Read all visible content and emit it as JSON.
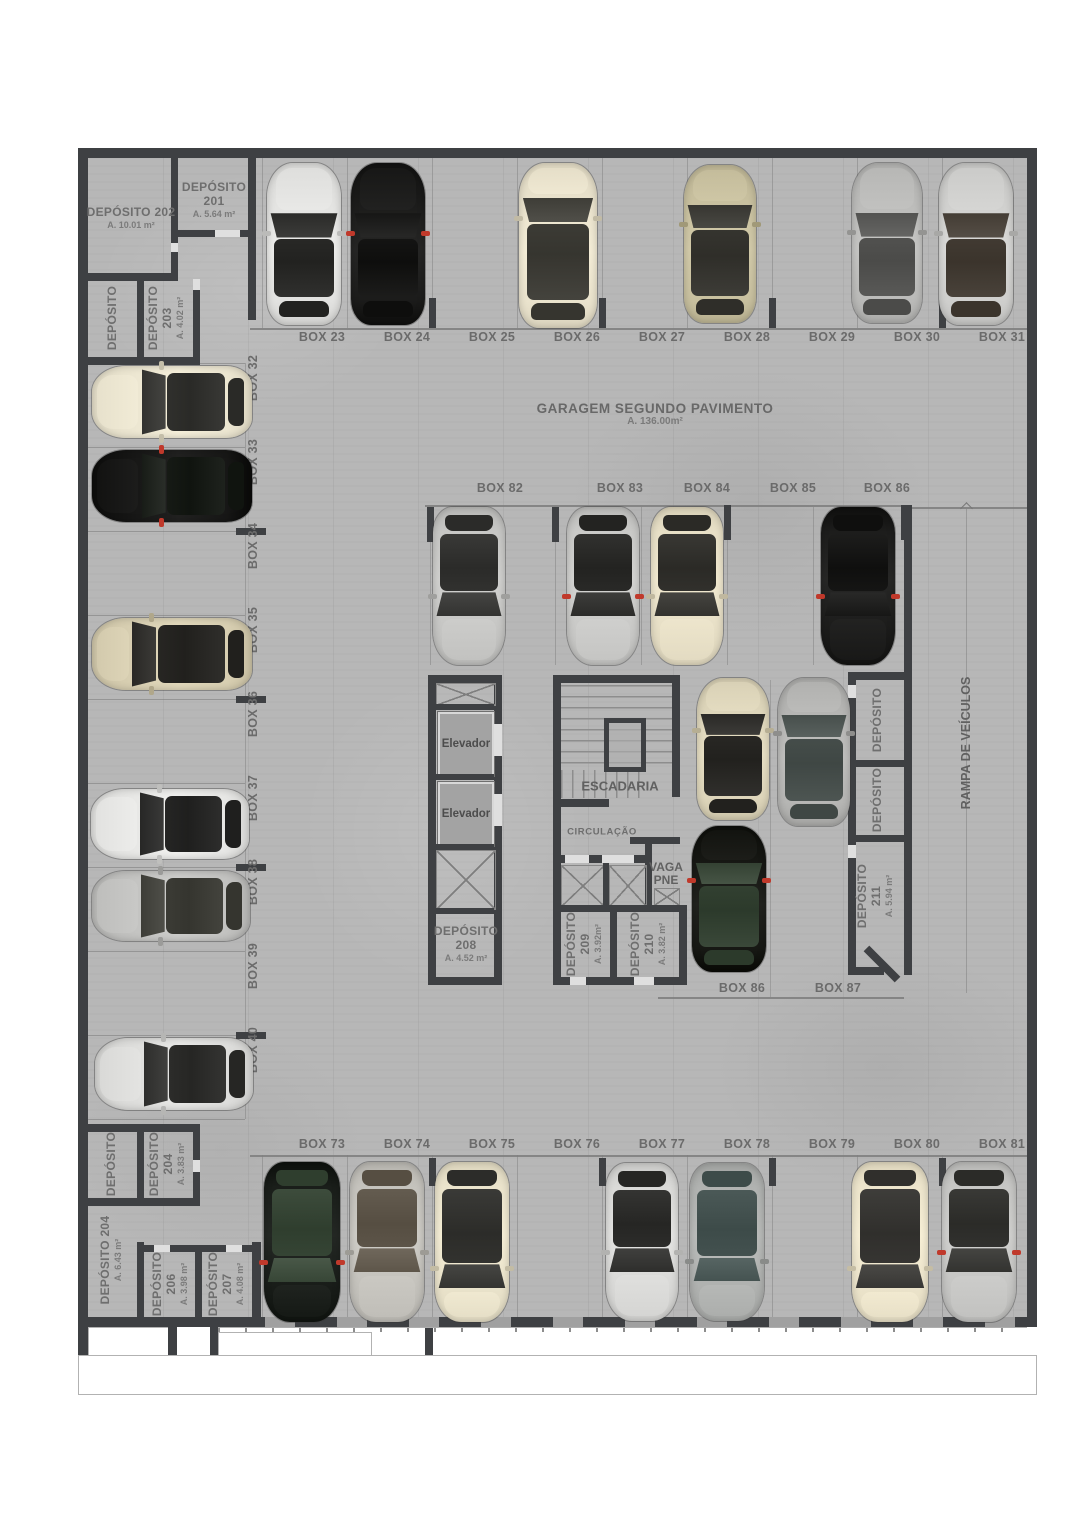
{
  "header": {
    "title": "GARAGEM SEGUNDO PAVIMENTO",
    "area": "A. 136.00m²"
  },
  "core": {
    "elevator1": "Elevador",
    "elevator2": "Elevador",
    "stairs": "ESCADARIA",
    "circulation": "CIRCULAÇÃO",
    "vaga_line1": "VAGA",
    "vaga_line2": "PNE",
    "ramp": "RAMPA DE VEÍCULOS"
  },
  "parking": {
    "top_row": [
      "BOX 23",
      "BOX 24",
      "BOX 25",
      "BOX 26",
      "BOX 27",
      "BOX 28",
      "BOX 29",
      "BOX 30",
      "BOX 31"
    ],
    "left_col": [
      "BOX 32",
      "BOX 33",
      "BOX 34",
      "BOX 35",
      "BOX 36",
      "BOX 37",
      "BOX 38",
      "BOX 39",
      "BOX 40"
    ],
    "mid_row": [
      "BOX 82",
      "BOX 83",
      "BOX 84",
      "BOX 85",
      "BOX 86"
    ],
    "mid_bottom": [
      "BOX 86",
      "BOX 87"
    ],
    "bottom_row": [
      "BOX 73",
      "BOX 74",
      "BOX 75",
      "BOX 76",
      "BOX 77",
      "BOX 78",
      "BOX 79",
      "BOX 80",
      "BOX 81"
    ]
  },
  "depots": {
    "d202": {
      "name": "DEPÓSITO 202",
      "area": "A. 10.01 m²"
    },
    "d201": {
      "name": "DEPÓSITO",
      "num": "201",
      "area": "A. 5.64 m²"
    },
    "d_tl": {
      "name": "DEPÓSITO"
    },
    "d203": {
      "name": "DEPÓSITO",
      "num": "203",
      "area": "A. 4.02 m²"
    },
    "d208": {
      "name": "DEPÓSITO",
      "num": "208",
      "area": "A. 4.52 m²"
    },
    "d209": {
      "name": "DEPÓSITO",
      "num": "209",
      "area": "A. 3.92m²"
    },
    "d210": {
      "name": "DEPÓSITO",
      "num": "210",
      "area": "A. 3.82 m²"
    },
    "d211": {
      "name": "DEPÓSITO",
      "num": "211",
      "area": "A. 5.94 m²"
    },
    "d_r1": {
      "name": "DEPÓSITO"
    },
    "d_r2": {
      "name": "DEPÓSITO"
    },
    "d_bl": {
      "name": "DEPÓSITO"
    },
    "d204a": {
      "name": "DEPÓSITO",
      "num": "204",
      "area": "A. 3.83 m²"
    },
    "d204b": {
      "name": "DEPÓSITO 204",
      "area": "A. 6.43 m²"
    },
    "d206": {
      "name": "DEPÓSITO",
      "num": "206",
      "area": "A. 3.98 m²"
    },
    "d207": {
      "name": "DEPÓSITO",
      "num": "207",
      "area": "A. 4.08 m²"
    }
  },
  "colors": {
    "wall": "#3e4043",
    "floor": "#b7b7b7",
    "label": "#6b6b6b",
    "thin_line": "#7d7d7d",
    "elevator_fill": "#a3a3a3",
    "accent_red": "#c0392b"
  },
  "cars": [
    {
      "spot": "box-23",
      "cx": 226,
      "cy": 96,
      "len": 162,
      "wid": 74,
      "rot": 180,
      "kind": "sedan",
      "body": "#e3e3e1",
      "glass": "#222220"
    },
    {
      "spot": "box-24",
      "cx": 310,
      "cy": 96,
      "len": 162,
      "wid": 74,
      "rot": 180,
      "kind": "sedan",
      "body": "#1c1c1b",
      "glass": "#0e0e0d",
      "accent": "#c0392b"
    },
    {
      "spot": "box-26",
      "cx": 480,
      "cy": 97,
      "len": 165,
      "wid": 78,
      "rot": 180,
      "kind": "van",
      "body": "#eae3cd",
      "glass": "#36352f"
    },
    {
      "spot": "box-28",
      "cx": 642,
      "cy": 96,
      "len": 158,
      "wid": 72,
      "rot": 180,
      "kind": "suv",
      "body": "#c9c1a0",
      "glass": "#2f2e29"
    },
    {
      "spot": "box-30",
      "cx": 809,
      "cy": 95,
      "len": 160,
      "wid": 70,
      "rot": 180,
      "kind": "sedan",
      "body": "#bcbcba",
      "glass": "#4b4b49"
    },
    {
      "spot": "box-31",
      "cx": 898,
      "cy": 96,
      "len": 162,
      "wid": 74,
      "rot": 180,
      "kind": "sedan",
      "body": "#d0d0ce",
      "glass": "#3b342c"
    },
    {
      "spot": "box-32",
      "cx": 94,
      "cy": 254,
      "len": 160,
      "wid": 72,
      "rot": 90,
      "kind": "sedan",
      "body": "#ece6d1",
      "glass": "#2a2a27"
    },
    {
      "spot": "box-33",
      "cx": 94,
      "cy": 338,
      "len": 160,
      "wid": 72,
      "rot": 90,
      "kind": "sedan",
      "body": "#171716",
      "glass": "#10140f",
      "accent": "#c0392b"
    },
    {
      "spot": "box-35",
      "cx": 94,
      "cy": 506,
      "len": 160,
      "wid": 72,
      "rot": 90,
      "kind": "suv",
      "body": "#d8cfb2",
      "glass": "#21201d"
    },
    {
      "spot": "box-37",
      "cx": 92,
      "cy": 676,
      "len": 158,
      "wid": 70,
      "rot": 90,
      "kind": "sedan",
      "body": "#e7e7e5",
      "glass": "#1f1f1e"
    },
    {
      "spot": "box-38",
      "cx": 93,
      "cy": 758,
      "len": 158,
      "wid": 70,
      "rot": 90,
      "kind": "sedan",
      "body": "#c3c3c1",
      "glass": "#35352f"
    },
    {
      "spot": "box-40",
      "cx": 96,
      "cy": 926,
      "len": 158,
      "wid": 72,
      "rot": 90,
      "kind": "sedan",
      "body": "#dededc",
      "glass": "#262624"
    },
    {
      "spot": "box-82",
      "cx": 391,
      "cy": 438,
      "len": 158,
      "wid": 72,
      "rot": 0,
      "kind": "sedan",
      "body": "#c7c7c5",
      "glass": "#2b2b29"
    },
    {
      "spot": "box-83",
      "cx": 525,
      "cy": 438,
      "len": 158,
      "wid": 72,
      "rot": 0,
      "kind": "sedan",
      "body": "#cacac8",
      "glass": "#232321",
      "accent": "#c0392b"
    },
    {
      "spot": "box-84",
      "cx": 609,
      "cy": 438,
      "len": 158,
      "wid": 72,
      "rot": 0,
      "kind": "sedan",
      "body": "#e8e0c7",
      "glass": "#2b2a26"
    },
    {
      "spot": "box-86-upper",
      "cx": 780,
      "cy": 438,
      "len": 158,
      "wid": 74,
      "rot": 0,
      "kind": "sedan",
      "body": "#1d1d1c",
      "glass": "#0f0f0e",
      "accent": "#c0392b"
    },
    {
      "spot": "box-86-col-a",
      "cx": 655,
      "cy": 601,
      "len": 142,
      "wid": 72,
      "rot": 180,
      "kind": "suv",
      "body": "#ded6bb",
      "glass": "#22211e"
    },
    {
      "spot": "box-86-col-b",
      "cx": 651,
      "cy": 751,
      "len": 146,
      "wid": 74,
      "rot": 180,
      "kind": "suv",
      "body": "#171814",
      "glass": "#2c3a2b",
      "accent": "#c0392b"
    },
    {
      "spot": "box-87-col",
      "cx": 736,
      "cy": 604,
      "len": 148,
      "wid": 72,
      "rot": 180,
      "kind": "suv",
      "body": "#b6b6b4",
      "glass": "#3f4744"
    },
    {
      "spot": "box-73",
      "cx": 224,
      "cy": 1094,
      "len": 160,
      "wid": 76,
      "rot": 0,
      "kind": "suv",
      "body": "#1a1e1a",
      "glass": "#2f3e2e",
      "accent": "#c0392b"
    },
    {
      "spot": "box-74",
      "cx": 309,
      "cy": 1094,
      "len": 160,
      "wid": 74,
      "rot": 0,
      "kind": "sedan",
      "body": "#c5c3bd",
      "glass": "#564e42"
    },
    {
      "spot": "box-75",
      "cx": 394,
      "cy": 1094,
      "len": 160,
      "wid": 74,
      "rot": 0,
      "kind": "van",
      "body": "#ebe4cc",
      "glass": "#2c2c29"
    },
    {
      "spot": "box-77",
      "cx": 564,
      "cy": 1094,
      "len": 158,
      "wid": 72,
      "rot": 0,
      "kind": "sedan",
      "body": "#dadad8",
      "glass": "#262624"
    },
    {
      "spot": "box-78",
      "cx": 649,
      "cy": 1094,
      "len": 158,
      "wid": 74,
      "rot": 0,
      "kind": "suv",
      "body": "#b1b3b1",
      "glass": "#3d4b49"
    },
    {
      "spot": "box-80",
      "cx": 812,
      "cy": 1094,
      "len": 160,
      "wid": 76,
      "rot": 0,
      "kind": "van",
      "body": "#ede5cc",
      "glass": "#302f2c"
    },
    {
      "spot": "box-81",
      "cx": 901,
      "cy": 1094,
      "len": 160,
      "wid": 74,
      "rot": 0,
      "kind": "sedan",
      "body": "#c7c7c5",
      "glass": "#2b2b28",
      "accent": "#c0392b"
    }
  ]
}
